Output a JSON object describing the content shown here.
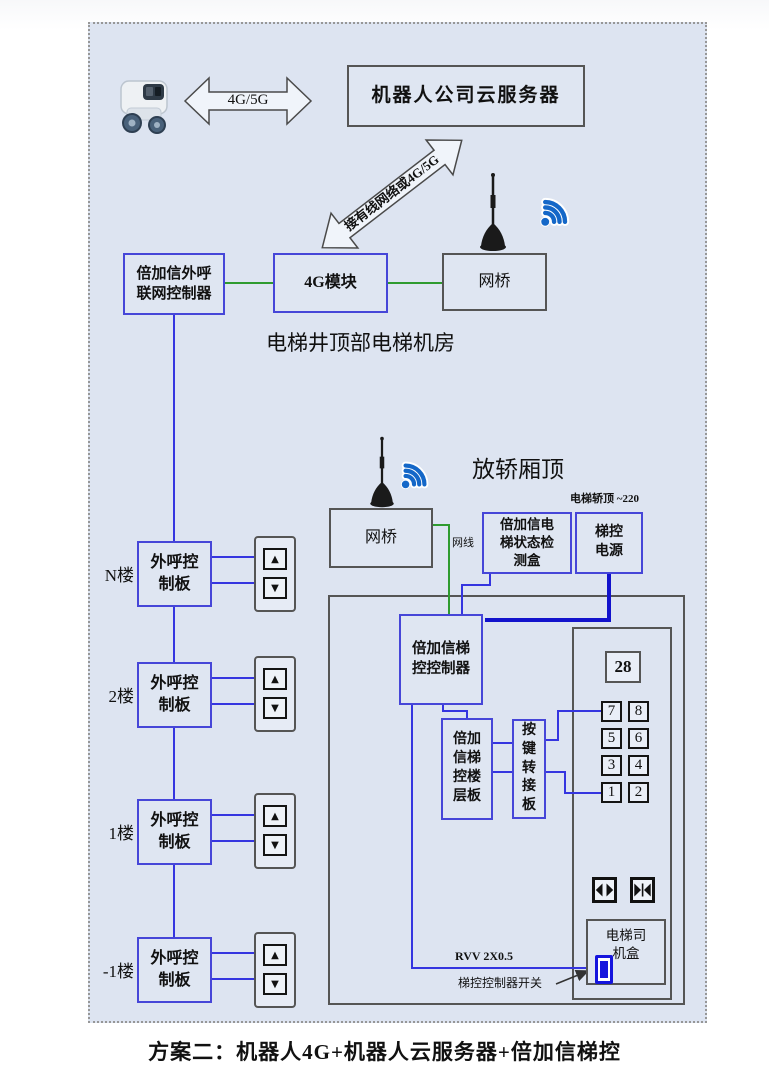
{
  "page": {
    "caption": "方案二：机器人4G+机器人云服务器+倍加信梯控"
  },
  "top_section": {
    "robot_link_label": "4G/5G",
    "cloud_server": "机器人公司云服务器",
    "uplink_label": "接有线网络或4G/5G",
    "outcall_controller": "倍加信外呼\n联网控制器",
    "module_4g": "4G模块",
    "bridge": "网桥",
    "location_caption": "电梯井顶部电梯机房"
  },
  "car_top_section": {
    "caption": "放轿厢顶",
    "power_note": "电梯轿顶 ~220",
    "bridge": "网桥",
    "cable_label": "网线",
    "status_box": "倍加信电\n梯状态检\n测盒",
    "power_box": "梯控\n电源"
  },
  "cabin_section": {
    "controller": "倍加信梯\n控控制器",
    "floor_board": "倍加\n信梯\n控楼\n层板",
    "key_adapter": "按\n键\n转\n接\n板",
    "display_value": "28",
    "cop_buttons": [
      "7",
      "8",
      "5",
      "6",
      "3",
      "4",
      "1",
      "2"
    ],
    "driver_box": "电梯司\n机盒",
    "cable_label": "RVV 2X0.5",
    "switch_label": "梯控控制器开关"
  },
  "floors": [
    {
      "label": "N楼",
      "board": "外呼控\n制板"
    },
    {
      "label": "2楼",
      "board": "外呼控\n制板"
    },
    {
      "label": "1楼",
      "board": "外呼控\n制板"
    },
    {
      "label": "-1楼",
      "board": "外呼控\n制板"
    }
  ],
  "icons": {
    "up_button_glyph": "▲",
    "down_button_glyph": "▼",
    "robot": "robot-icon",
    "antenna": "antenna-icon",
    "wifi": "wifi-icon",
    "door_open": "door-open-icon",
    "door_close": "door-close-icon",
    "power_switch": "power-switch-icon"
  },
  "colors": {
    "panel_bg": "#dde4f1",
    "blue_border": "#4646d8",
    "gray_border": "#555555",
    "green_wire": "#2f9b2f",
    "blue_wire": "#3535e0",
    "thick_blue_wire": "#1212cc"
  }
}
